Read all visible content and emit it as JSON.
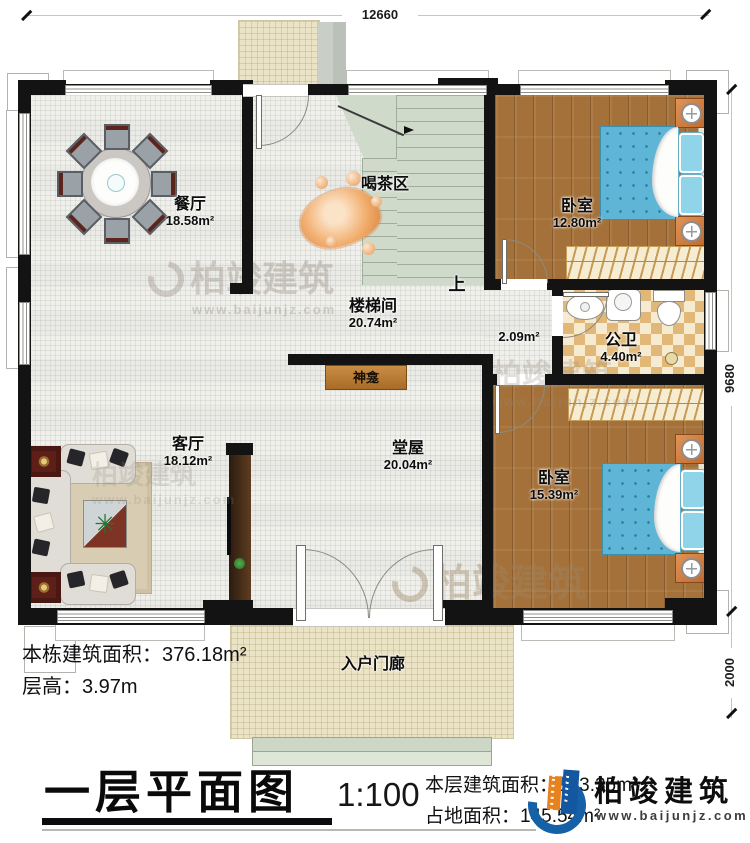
{
  "plan": {
    "dimensions": {
      "width_top": "12660",
      "height_right_main": "9680",
      "height_right_porch": "2000"
    },
    "rooms": {
      "dining": {
        "name": "餐厅",
        "area": "18.58m²"
      },
      "tea": {
        "name": "喝茶区"
      },
      "stairwell": {
        "name": "楼梯间",
        "area": "20.74m²"
      },
      "bedroom_top": {
        "name": "卧室",
        "area": "12.80m²"
      },
      "bathroom": {
        "name": "公卫",
        "area": "4.40m²"
      },
      "corridor": {
        "area": "2.09m²"
      },
      "shrine": {
        "name": "神龛"
      },
      "living": {
        "name": "客厅",
        "area": "18.12m²"
      },
      "hall": {
        "name": "堂屋",
        "area": "20.04m²"
      },
      "bedroom_bottom": {
        "name": "卧室",
        "area": "15.39m²"
      },
      "porch": {
        "name": "入户门廊"
      },
      "stairs_up": {
        "label": "上"
      }
    }
  },
  "notes": {
    "total_area_label": "本栋建筑面积：",
    "total_area_value": "376.18m²",
    "floor_height_label": "层高：",
    "floor_height_value": "3.97m"
  },
  "titleblock": {
    "title": "一层平面图",
    "scale": "1:100",
    "floor_area_label": "本层建筑面积：",
    "floor_area_value": "133.35m²",
    "land_area_label": "占地面积：",
    "land_area_value": "145.54m²"
  },
  "brand": {
    "name": "柏竣建筑",
    "website": "www.baijunjz.com"
  },
  "watermark": {
    "name": "柏竣建筑",
    "website": "www.baijunjz.com"
  },
  "icons": {
    "plant": "✳"
  }
}
